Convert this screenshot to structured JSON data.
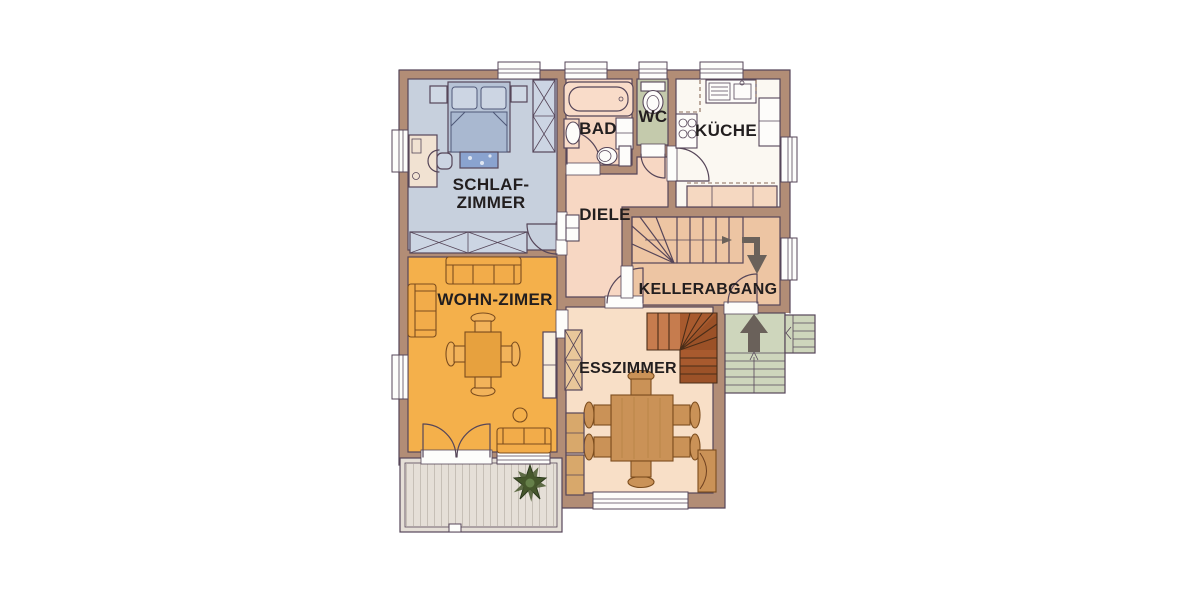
{
  "plan": {
    "rooms": {
      "schlafzimmer": {
        "label_line1": "SCHLAF-",
        "label_line2": "ZIMMER"
      },
      "bad": {
        "label": "BAD"
      },
      "wc": {
        "label": "WC"
      },
      "kueche": {
        "label": "KÜCHE"
      },
      "diele": {
        "label": "DIELE"
      },
      "kellerabgang": {
        "label": "KELLERABGANG"
      },
      "wohnzimmer": {
        "label": "WOHN-ZIMER"
      },
      "esszimmer": {
        "label": "ESSZIMMER"
      }
    },
    "colors": {
      "wall": "#b28d76",
      "outline": "#564659",
      "bedroom_floor": "#c7d0dd",
      "bed_blanket": "#a9b8d0",
      "bath_floor": "#f7d7c3",
      "wc_floor": "#c4caac",
      "kitchen_floor": "#fbf8f2",
      "diele_floor": "#f7d7c3",
      "keller_floor": "#edc5a3",
      "living_floor": "#f4b04b",
      "dining_floor": "#f8dfc7",
      "porch_floor": "#ced6bc",
      "terrace_floor": "#e5dfd7",
      "stair_wood": "#a85a2e",
      "furniture_wood": "#ca9257",
      "arrow": "#6a615a",
      "plant": "#46572d",
      "text": "#221e1f"
    }
  }
}
